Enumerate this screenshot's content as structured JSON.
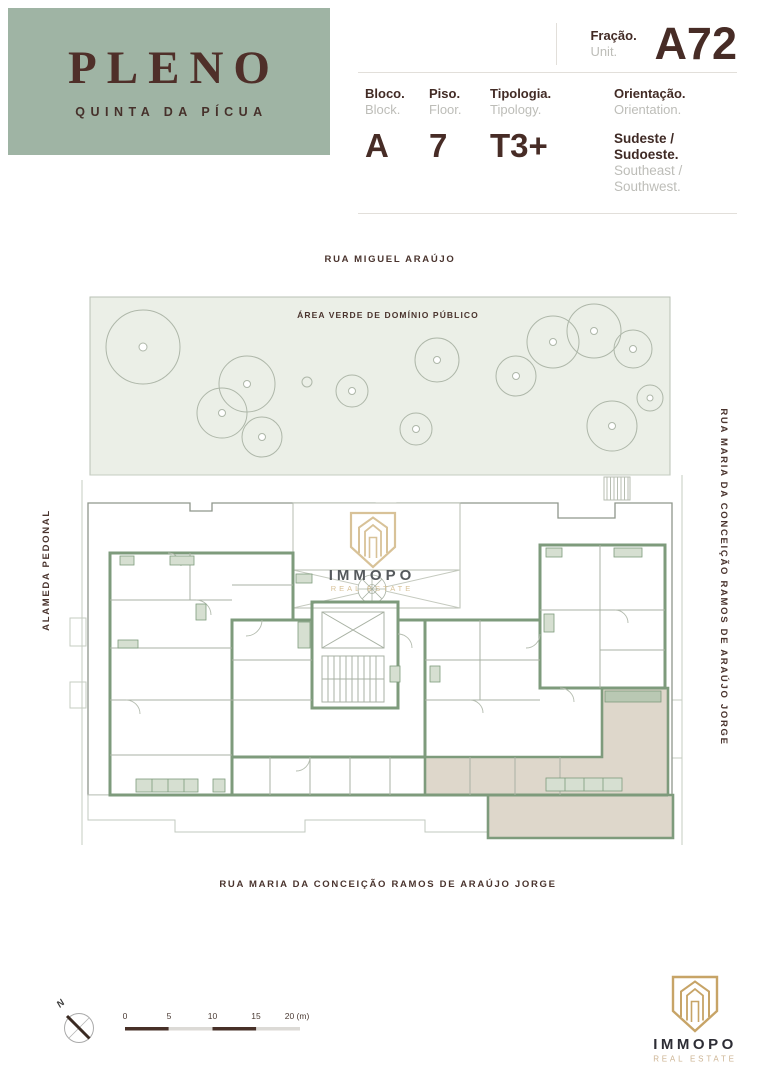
{
  "brand": {
    "name": "PLENO",
    "subtitle": "QUINTA DA PÍCUA"
  },
  "header": {
    "fraction_label": "Fração.",
    "fraction_label_en": "Unit.",
    "fraction_value": "A72",
    "fields": [
      {
        "label": "Bloco.",
        "label_en": "Block.",
        "value": "A"
      },
      {
        "label": "Piso.",
        "label_en": "Floor.",
        "value": "7"
      },
      {
        "label": "Tipologia.",
        "label_en": "Tipology.",
        "value": "T3+"
      }
    ],
    "orientation": {
      "label": "Orientação.",
      "label_en": "Orientation.",
      "value": "Sudeste / Sudoeste.",
      "value_en": "Southeast / Southwest."
    }
  },
  "plan": {
    "street_top": "RUA MIGUEL ARAÚJO",
    "street_bottom": "RUA MARIA DA CONCEIÇÃO RAMOS DE ARAÚJO JORGE",
    "street_left": "ALAMEDA PEDONAL",
    "street_right": "RUA MARIA DA CONCEIÇÃO RAMOS DE ARAÚJO JORGE",
    "green_area_label": "ÁREA VERDE DE DOMÍNIO PÚBLICO",
    "watermark": {
      "name": "IMMOPO",
      "tagline": "REAL ESTATE"
    }
  },
  "compass": {
    "north_label": "N"
  },
  "scale_bar": {
    "ticks": [
      "0",
      "5",
      "10",
      "15"
    ],
    "end_label": "20 (m)"
  },
  "footer_logo": {
    "name": "IMMOPO",
    "tagline": "REAL ESTATE"
  },
  "colors": {
    "brand_green": "#9fb4a4",
    "brand_maroon": "#472c26",
    "wall_green": "#7e9b7c",
    "highlight_beige": "#ded7cb",
    "gold": "#c7a467"
  }
}
